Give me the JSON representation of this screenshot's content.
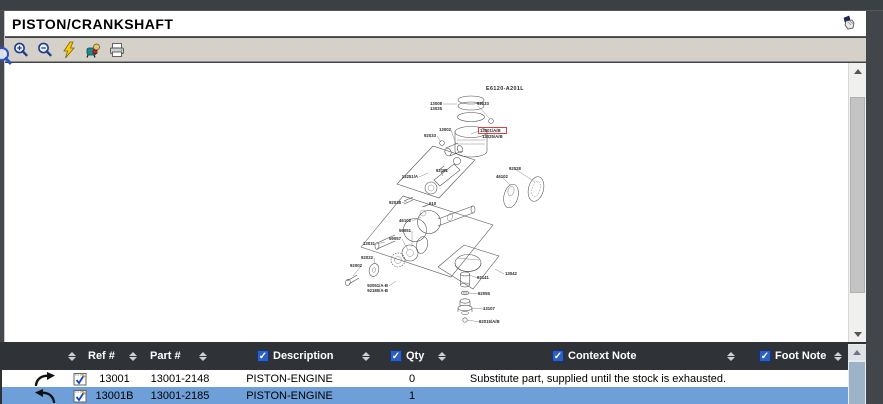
{
  "window": {
    "title": "PISTON/CRANKSHAFT"
  },
  "colors": {
    "selection_blue": "#6f9fd8",
    "checkbox_blue": "#2a5fc4",
    "highlight_red": "#e02a2a",
    "header_dark": "#2f3337",
    "toolbar_gray": "#d5d1c9"
  },
  "toolbar": {
    "icons": [
      "zoom-in-icon",
      "zoom-out-icon",
      "flash-icon",
      "hotspot-tool-icon",
      "print-icon"
    ],
    "corner_icon": "hand-icon"
  },
  "diagram": {
    "code": "E6120-A201L",
    "highlighted_label": "13001/A/B",
    "labels": [
      {
        "t": "13008",
        "x": 437,
        "y": 105,
        "a": "end"
      },
      {
        "t": "13025",
        "x": 437,
        "y": 110,
        "a": "end"
      },
      {
        "t": "92033",
        "x": 472,
        "y": 105,
        "a": "start"
      },
      {
        "t": "13002",
        "x": 446,
        "y": 131,
        "a": "end"
      },
      {
        "t": "92033",
        "x": 431,
        "y": 137,
        "a": "end"
      },
      {
        "t": "13001/A/B",
        "x": 475,
        "y": 132,
        "a": "start"
      },
      {
        "t": "13025/A/B",
        "x": 477,
        "y": 138,
        "a": "start"
      },
      {
        "t": "13251/A",
        "x": 413,
        "y": 178,
        "a": "end"
      },
      {
        "t": "92151",
        "x": 431,
        "y": 172,
        "a": "start"
      },
      {
        "t": "92028",
        "x": 504,
        "y": 170,
        "a": "start"
      },
      {
        "t": "46102",
        "x": 491,
        "y": 178,
        "a": "start"
      },
      {
        "t": "92038",
        "x": 396,
        "y": 204,
        "a": "end"
      },
      {
        "t": "510",
        "x": 424,
        "y": 205,
        "a": "start"
      },
      {
        "t": "46102",
        "x": 406,
        "y": 222,
        "a": "end"
      },
      {
        "t": "59051",
        "x": 406,
        "y": 232,
        "a": "end"
      },
      {
        "t": "59057",
        "x": 396,
        "y": 240,
        "a": "end"
      },
      {
        "t": "13031",
        "x": 370,
        "y": 245,
        "a": "end"
      },
      {
        "t": "92022",
        "x": 368,
        "y": 259,
        "a": "end"
      },
      {
        "t": "92002",
        "x": 357,
        "y": 267,
        "a": "end"
      },
      {
        "t": "92051/A-B",
        "x": 383,
        "y": 287,
        "a": "end"
      },
      {
        "t": "92180/A-B",
        "x": 383,
        "y": 292,
        "a": "end"
      },
      {
        "t": "13042",
        "x": 500,
        "y": 275,
        "a": "start"
      },
      {
        "t": "92141",
        "x": 472,
        "y": 279,
        "a": "start"
      },
      {
        "t": "92055",
        "x": 473,
        "y": 295,
        "a": "start"
      },
      {
        "t": "13107",
        "x": 478,
        "y": 310,
        "a": "start"
      },
      {
        "t": "92015/A/B",
        "x": 474,
        "y": 323,
        "a": "start"
      }
    ]
  },
  "table": {
    "header": {
      "ref_label": "Ref #",
      "part_label": "Part #",
      "description_label": "Description",
      "qty_label": "Qty",
      "context_label": "Context Note",
      "foot_label": "Foot Note",
      "checkbox_glyph": "✓"
    },
    "rows": [
      {
        "ref": "13001",
        "part": "13001-2148",
        "description": "PISTON-ENGINE",
        "qty": "0",
        "context_note": "Substitute part, supplied until the stock is exhausted.",
        "foot_note": "",
        "selected": false
      },
      {
        "ref": "13001B",
        "part": "13001-2185",
        "description": "PISTON-ENGINE",
        "qty": "1",
        "context_note": "",
        "foot_note": "",
        "selected": true
      }
    ]
  }
}
